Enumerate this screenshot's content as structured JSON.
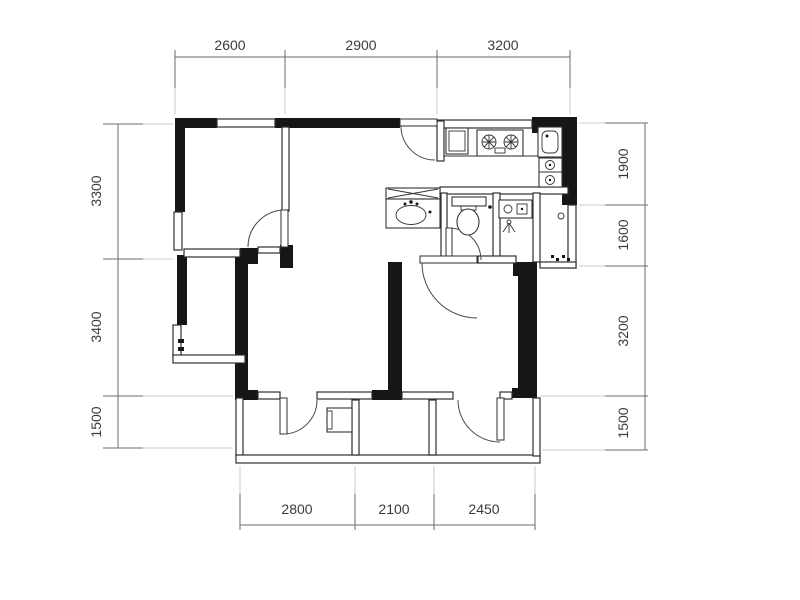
{
  "page": {
    "title": "Apartment Floor Plan",
    "background": "#ffffff"
  },
  "colors": {
    "wall": "#161616",
    "thin_line": "#2e2e2e",
    "dim_line": "#6b6b6b",
    "dim_text": "#3a3a3a",
    "extension_line": "#bdbdbd",
    "background": "#ffffff"
  },
  "dimensions": {
    "top": [
      "2600",
      "2900",
      "3200"
    ],
    "bottom": [
      "2800",
      "2100",
      "2450"
    ],
    "left": [
      "3300",
      "3400",
      "1500"
    ],
    "right": [
      "1900",
      "1600",
      "3200",
      "1500"
    ]
  },
  "fixtures": [
    "fridge-icon",
    "gas-stove-two-burner-icon",
    "kitchen-sink-icon",
    "double-basin-sink-icon",
    "vanity-washbasin-icon",
    "mirror-cabinet-x-icon",
    "toilet-icon",
    "washing-machine-icon",
    "floor-drain-icon",
    "door-knob-icon",
    "water-heater-unit-icon",
    "threshold-marks-icon"
  ]
}
